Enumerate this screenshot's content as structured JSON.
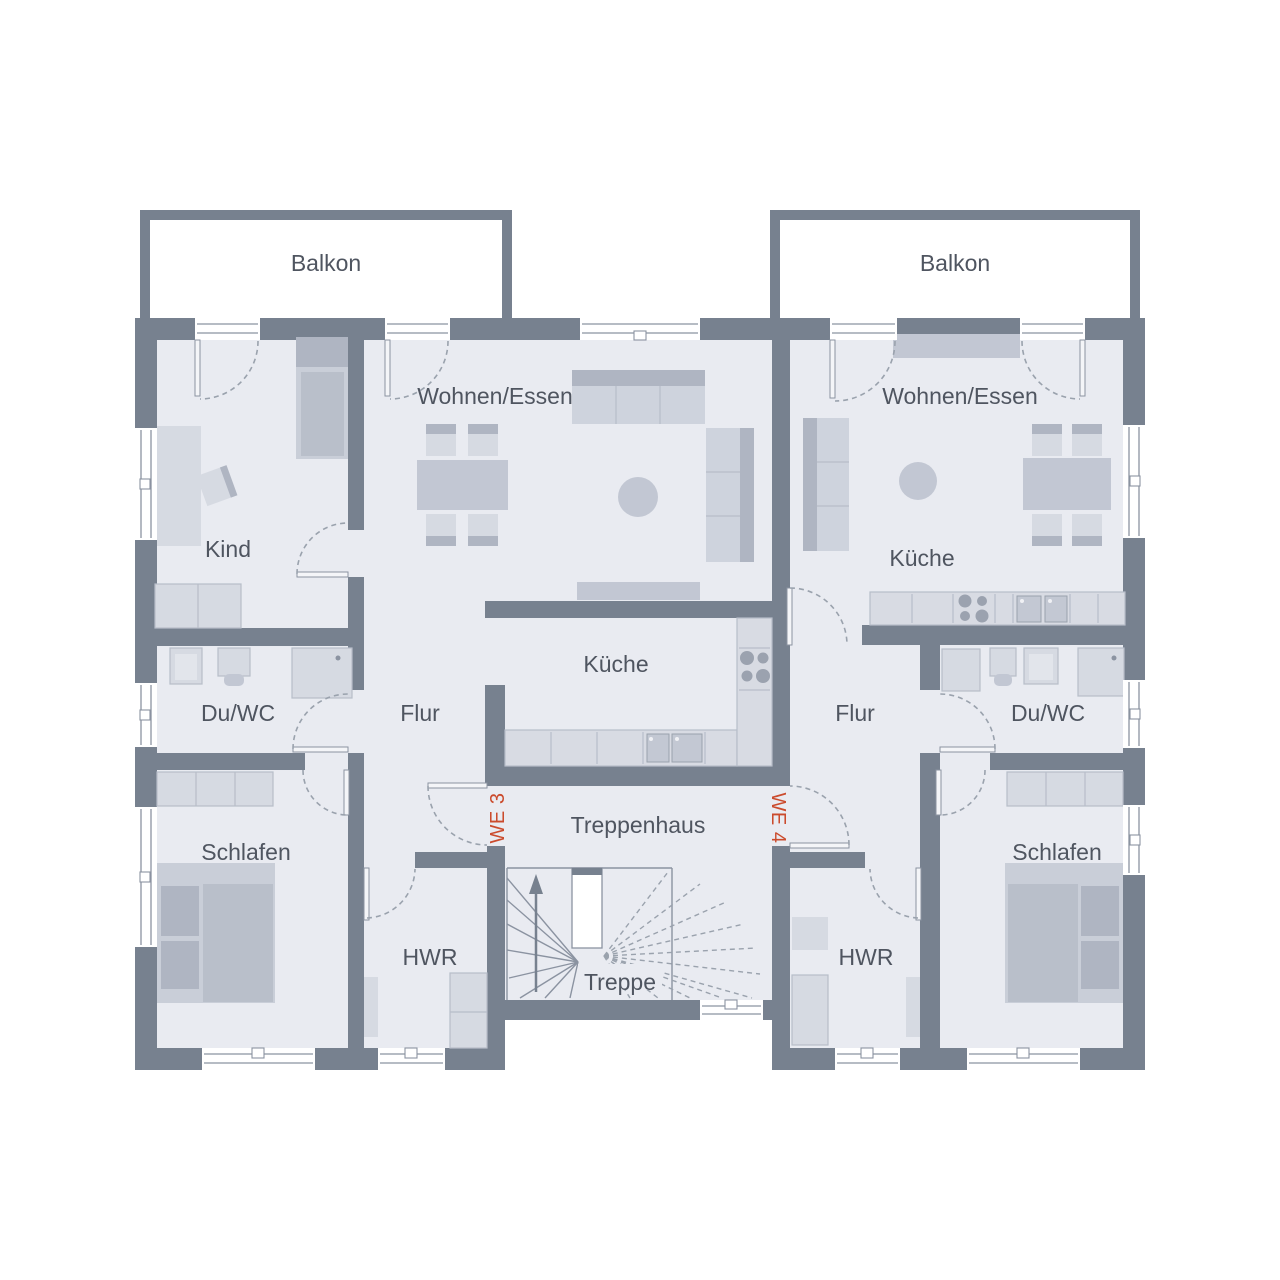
{
  "floor_plan": {
    "balconies": [
      {
        "label": "Balkon"
      },
      {
        "label": "Balkon"
      }
    ],
    "units": [
      {
        "id": "WE 3",
        "rooms": {
          "wohnen_essen": "Wohnen/Essen",
          "kind": "Kind",
          "kueche": "Küche",
          "du_wc": "Du/WC",
          "flur": "Flur",
          "schlafen": "Schlafen",
          "hwr": "HWR"
        }
      },
      {
        "id": "WE 4",
        "rooms": {
          "wohnen_essen": "Wohnen/Essen",
          "kueche": "Küche",
          "du_wc": "Du/WC",
          "flur": "Flur",
          "schlafen": "Schlafen",
          "hwr": "HWR"
        }
      }
    ],
    "stairwell": {
      "treppenhaus": "Treppenhaus",
      "treppe": "Treppe"
    },
    "colors": {
      "wall": "#77818F",
      "floor": "#E9EBF1",
      "accent_red": "#CB4B2D",
      "furniture_light": "#D6DAE2",
      "furniture_mid": "#C2C7D3",
      "furniture_dark": "#AFB5C2",
      "label_text": "#4F5560",
      "frame_line": "#8B93A1"
    }
  }
}
